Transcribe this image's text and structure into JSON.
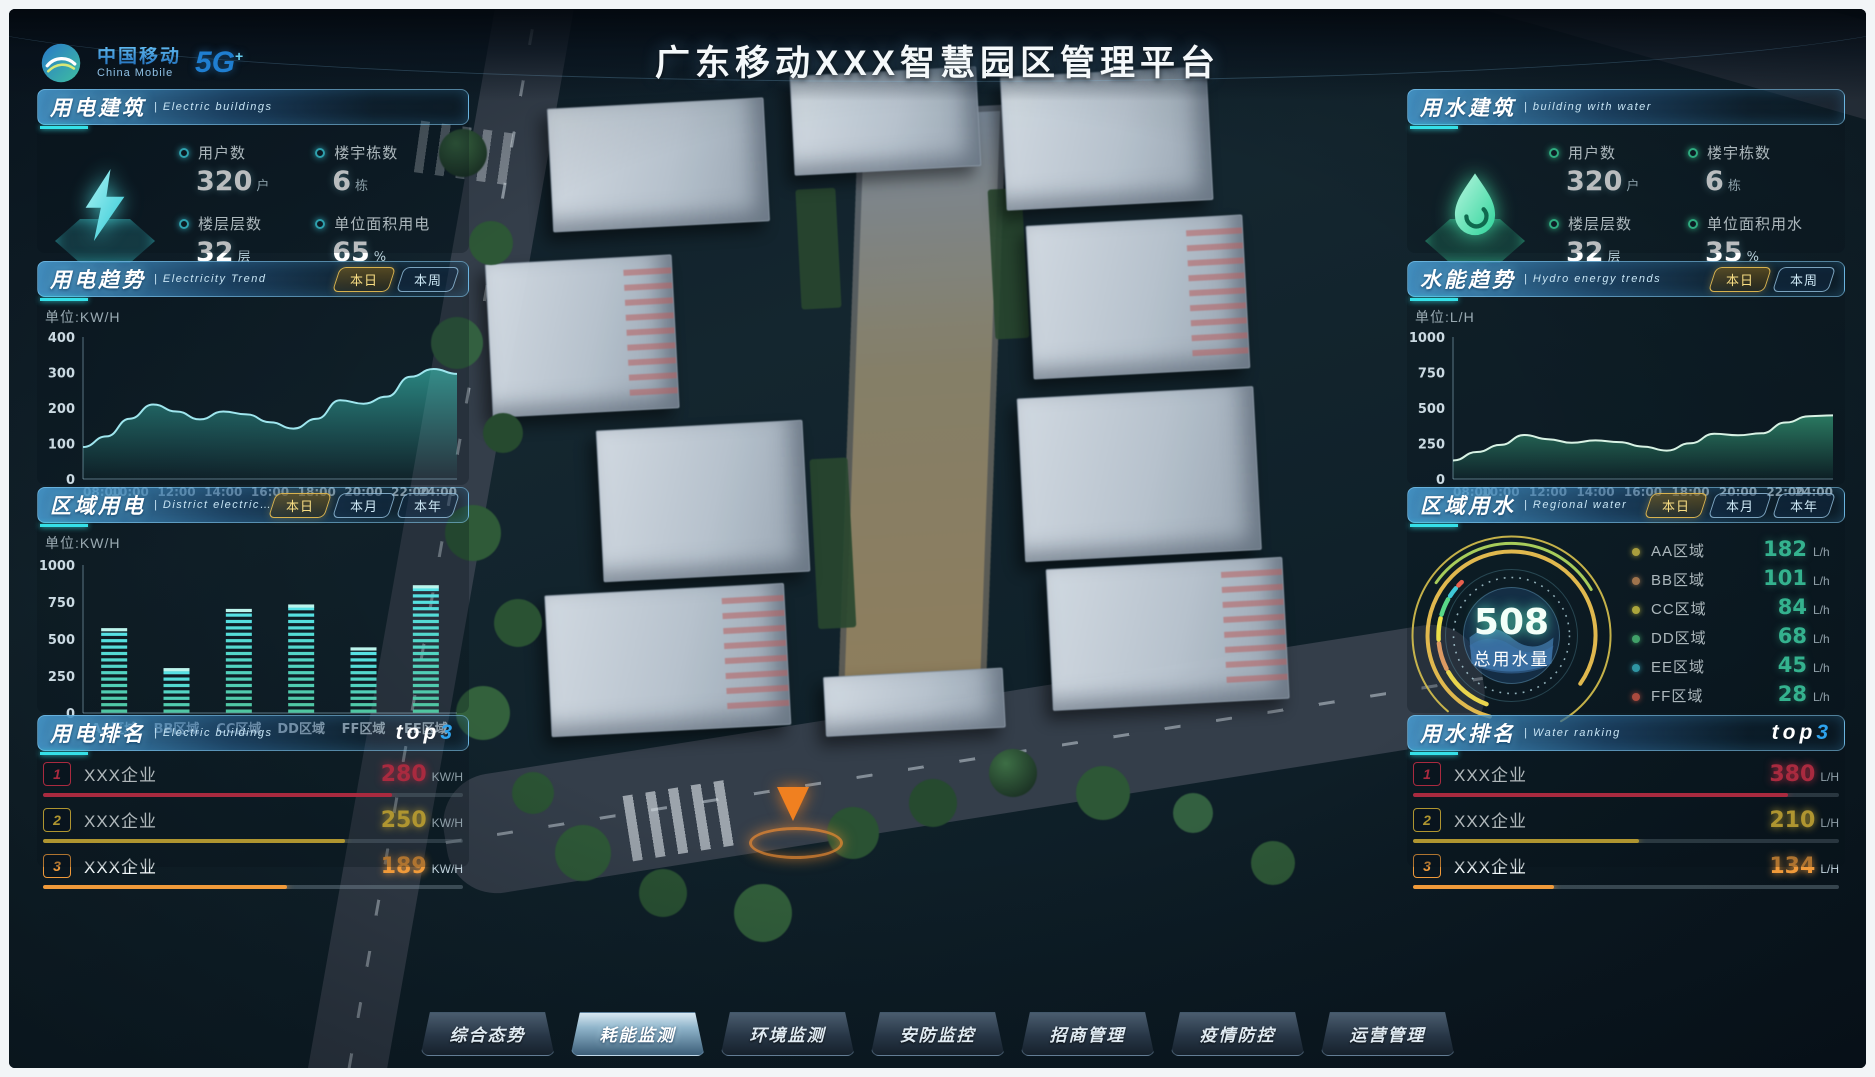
{
  "meta": {
    "title": "广东移动XXX智慧园区管理平台"
  },
  "brand": {
    "name_zh": "中国移动",
    "name_en": "China Mobile",
    "badge": "5G",
    "badge_plus": "+"
  },
  "panels": {
    "electric_building": {
      "title": "用电建筑",
      "subtitle": "| Electric buildings",
      "accent": "#3fd8e8",
      "stats": [
        {
          "label": "用户数",
          "value": "320",
          "unit": "户"
        },
        {
          "label": "楼宇栋数",
          "value": "6",
          "unit": "栋"
        },
        {
          "label": "楼层层数",
          "value": "32",
          "unit": "层"
        },
        {
          "label": "单位面积用电",
          "value": "65",
          "unit": "%"
        }
      ]
    },
    "electric_trend": {
      "title": "用电趋势",
      "subtitle": "| Electricity Trend",
      "unit_label": "单位:KW/H",
      "tabs": [
        "本日",
        "本周"
      ],
      "active": 0
    },
    "district_electric": {
      "title": "区域用电",
      "subtitle": "| District electricity",
      "unit_label": "单位:KW/H",
      "tabs": [
        "本日",
        "本月",
        "本年"
      ],
      "active": 0
    },
    "electric_rank": {
      "title": "用电排名",
      "subtitle": "| Electric buildings",
      "badge_top": "top",
      "badge_num": "3",
      "rows": [
        {
          "rank": "1",
          "name": "XXX企业",
          "value": "280",
          "unit": "KW/H",
          "color": "#e8344e",
          "bar_width": "83%"
        },
        {
          "rank": "2",
          "name": "XXX企业",
          "value": "250",
          "unit": "KW/H",
          "color": "#f0c83a",
          "bar_width": "72%"
        },
        {
          "rank": "3",
          "name": "XXX企业",
          "value": "189",
          "unit": "KW/H",
          "color": "#f09a3a",
          "bar_width": "58%"
        }
      ]
    },
    "water_building": {
      "title": "用水建筑",
      "subtitle": "| building with water",
      "accent": "#3fe8a8",
      "stats": [
        {
          "label": "用户数",
          "value": "320",
          "unit": "户"
        },
        {
          "label": "楼宇栋数",
          "value": "6",
          "unit": "栋"
        },
        {
          "label": "楼层层数",
          "value": "32",
          "unit": "层"
        },
        {
          "label": "单位面积用水",
          "value": "35",
          "unit": "%"
        }
      ]
    },
    "water_trend": {
      "title": "水能趋势",
      "subtitle": "| Hydro energy trends",
      "unit_label": "单位:L/H",
      "tabs": [
        "本日",
        "本周"
      ],
      "active": 0
    },
    "regional_water": {
      "title": "区域用水",
      "subtitle": "| Regional water",
      "tabs": [
        "本日",
        "本月",
        "本年"
      ],
      "active": 0,
      "gauge": {
        "value": "508",
        "label": "总用水量"
      },
      "legend": [
        {
          "name": "AA区域",
          "value": "182",
          "unit": "L/h",
          "color": "#e8d44d"
        },
        {
          "name": "BB区域",
          "value": "101",
          "unit": "L/h",
          "color": "#dc9a62"
        },
        {
          "name": "CC区域",
          "value": "84",
          "unit": "L/h",
          "color": "#ece04a"
        },
        {
          "name": "DD区域",
          "value": "68",
          "unit": "L/h",
          "color": "#58d888"
        },
        {
          "name": "EE区域",
          "value": "45",
          "unit": "L/h",
          "color": "#3fc8d8"
        },
        {
          "name": "FF区域",
          "value": "28",
          "unit": "L/h",
          "color": "#e8604d"
        }
      ]
    },
    "water_rank": {
      "title": "用水排名",
      "subtitle": "| Water ranking",
      "badge_top": "top",
      "badge_num": "3",
      "rows": [
        {
          "rank": "1",
          "name": "XXX企业",
          "value": "380",
          "unit": "L/H",
          "color": "#e8344e",
          "bar_width": "88%"
        },
        {
          "rank": "2",
          "name": "XXX企业",
          "value": "210",
          "unit": "L/H",
          "color": "#f0c83a",
          "bar_width": "53%"
        },
        {
          "rank": "3",
          "name": "XXX企业",
          "value": "134",
          "unit": "L/H",
          "color": "#f09a3a",
          "bar_width": "33%"
        }
      ]
    }
  },
  "nav": {
    "items": [
      "综合态势",
      "耗能监测",
      "环境监测",
      "安防监控",
      "招商管理",
      "疫情防控",
      "运营管理"
    ],
    "active": 1
  },
  "chart_data": [
    {
      "id": "electric-trend",
      "type": "area",
      "title": "用电趋势",
      "ylabel": "KW/H",
      "x_ticks": [
        "08:00",
        "10:00",
        "12:00",
        "14:00",
        "16:00",
        "18:00",
        "20:00",
        "22:00",
        "24:00"
      ],
      "values": [
        90,
        120,
        170,
        210,
        190,
        168,
        190,
        182,
        160,
        142,
        170,
        222,
        212,
        232,
        288,
        310,
        296
      ],
      "ylim": [
        0,
        400
      ],
      "y_ticks": [
        0,
        100,
        200,
        300,
        400
      ],
      "line_color": "#9fe6ee",
      "fill_from": "rgba(64,216,200,0.55)",
      "fill_to": "rgba(64,216,200,0.02)"
    },
    {
      "id": "district-electric",
      "type": "bar",
      "title": "区域用电",
      "ylabel": "KW/H",
      "categories": [
        "AA区域",
        "BB区域",
        "CC区域",
        "DD区域",
        "FF区域",
        "EE区域"
      ],
      "values": [
        560,
        290,
        690,
        720,
        430,
        850
      ],
      "ylim": [
        0,
        1000
      ],
      "y_ticks": [
        0,
        250,
        500,
        750,
        1000
      ],
      "bar_from": "#4fc49e",
      "bar_to": "#56e2e6"
    },
    {
      "id": "water-trend",
      "type": "area",
      "title": "水能趋势",
      "ylabel": "L/H",
      "x_ticks": [
        "08:00",
        "10:00",
        "12:00",
        "14:00",
        "16:00",
        "18:00",
        "20:00",
        "22:00",
        "24:00"
      ],
      "values": [
        130,
        190,
        240,
        310,
        280,
        255,
        272,
        260,
        228,
        200,
        252,
        318,
        308,
        322,
        398,
        442,
        448
      ],
      "ylim": [
        0,
        1000
      ],
      "y_ticks": [
        0,
        250,
        500,
        750,
        1000
      ],
      "line_color": "#d8f2e4",
      "fill_from": "rgba(72,216,160,0.5)",
      "fill_to": "rgba(72,216,160,0.03)"
    },
    {
      "id": "water-gauge",
      "type": "donut",
      "title": "区域用水",
      "total": 508,
      "label": "总用水量",
      "segments": [
        {
          "name": "AA区域",
          "value": 182,
          "color": "#e8d44d"
        },
        {
          "name": "BB区域",
          "value": 101,
          "color": "#dc9a62"
        },
        {
          "name": "CC区域",
          "value": 84,
          "color": "#ece04a"
        },
        {
          "name": "DD区域",
          "value": 68,
          "color": "#58d888"
        },
        {
          "name": "EE区域",
          "value": 45,
          "color": "#3fc8d8"
        },
        {
          "name": "FF区域",
          "value": 28,
          "color": "#e8604d"
        }
      ]
    }
  ]
}
